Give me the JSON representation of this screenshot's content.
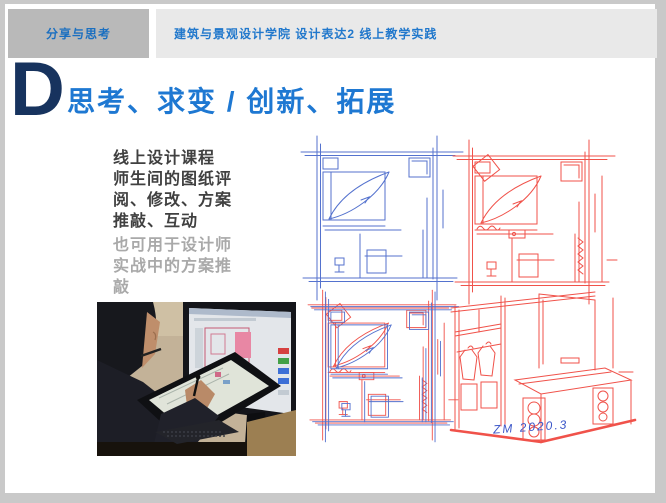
{
  "page": {
    "tab_label": "分享与思考",
    "header_title": "建筑与景观设计学院 设计表达2 线上教学实践",
    "slide_title": {
      "letter": "D",
      "text": "思考、求变 / 创新、拓展"
    },
    "body": {
      "primary": "线上设计课程\n师生间的图纸评\n阅、修改、方案\n推敲、互动",
      "secondary": "也可用于设计师\n实战中的方案推\n敲"
    },
    "signature": "ZM 2020.3",
    "figures": {
      "photo": "designer-sketching-on-pen-display-photo",
      "sketch_top_left": "blue-bedroom-plan-sketch",
      "sketch_top_right": "red-bedroom-plan-sketch",
      "sketch_bottom_left": "blue-red-overlay-plan-sketch",
      "sketch_bottom_right": "red-wardrobe-vanity-perspective-sketch"
    },
    "colors": {
      "accent_navy": "#17335E",
      "accent_blue": "#1E78D2",
      "tab_text_blue": "#1B6FC0",
      "sketch_blue": "#5472CE",
      "sketch_red": "#F0524A",
      "text_dark": "#404040",
      "text_muted": "#A9A9A9",
      "tab_bg": "#B9B9B9",
      "header_bg": "#E9E9E9",
      "frame_gray": "#C9C9C9",
      "signature_blue": "#3A55C8"
    }
  }
}
